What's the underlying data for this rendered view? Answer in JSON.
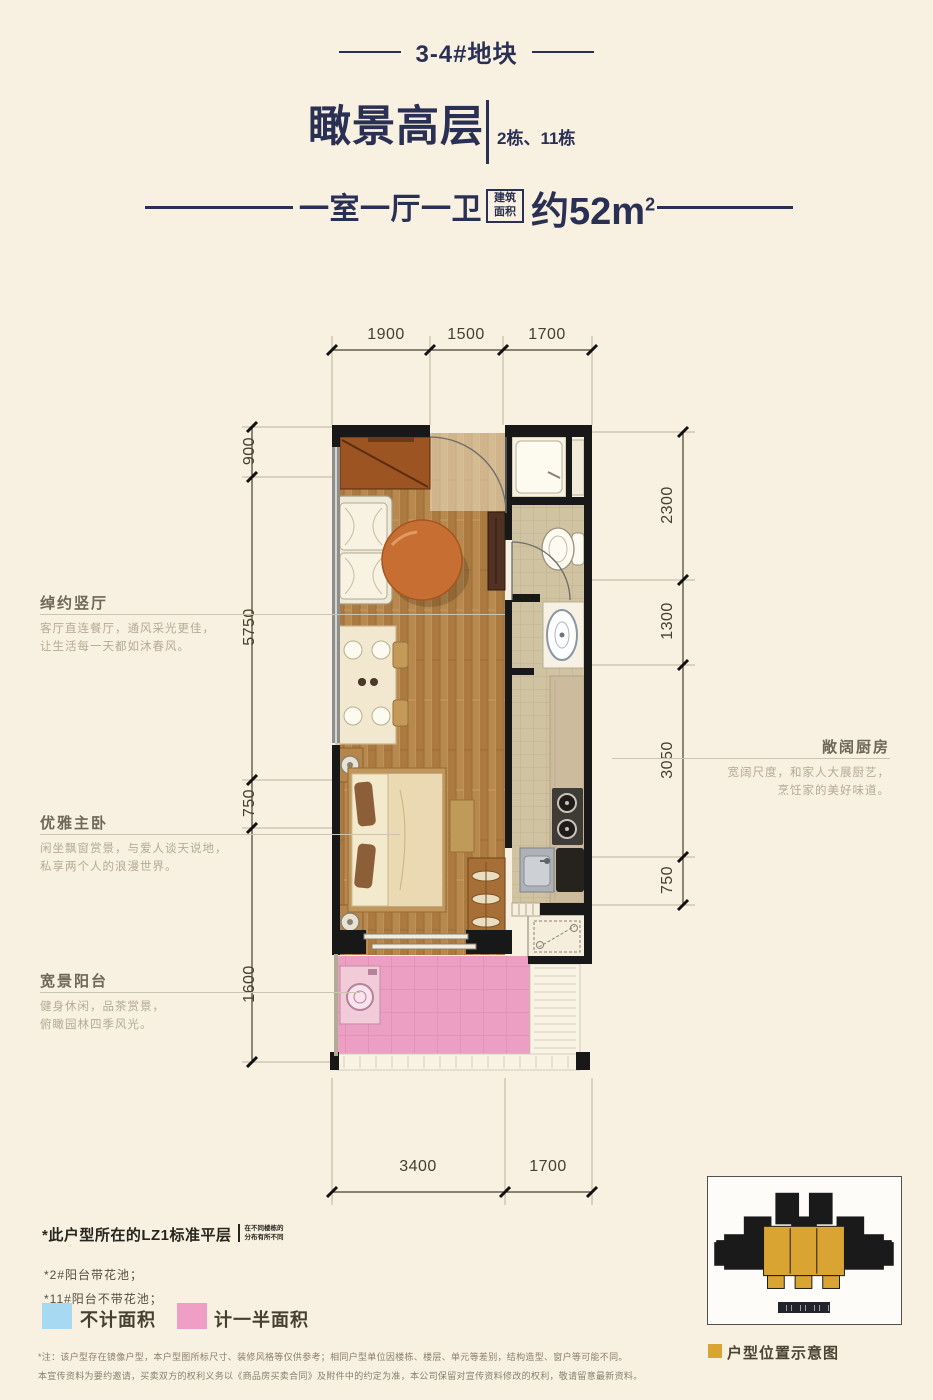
{
  "colors": {
    "background": "#f8f0e0",
    "accent_navy": "#2a3054",
    "wall_black": "#181818",
    "balcony_pink": "#ec9fc3",
    "legend_blue": "#a7d9f2",
    "legend_pink": "#ef9fc6",
    "site_gold": "#d9a432"
  },
  "header": {
    "lot": "3-4#地块",
    "title": "瞰景高层",
    "buildings": "2栋、11栋",
    "layout": "一室一厅一卫",
    "area_label_line1": "建筑",
    "area_label_line2": "面积",
    "area_value": "约52m",
    "area_sup": "2"
  },
  "plan": {
    "dims_top": [
      "1900",
      "1500",
      "1700"
    ],
    "dims_left": [
      "900",
      "5750",
      "750",
      "1600"
    ],
    "dims_right": [
      "2300",
      "1300",
      "3050",
      "750"
    ],
    "dims_bottom": [
      "3400",
      "1700"
    ]
  },
  "callouts": {
    "living": {
      "title": "绰约竖厅",
      "desc1": "客厅直连餐厅，通风采光更佳，",
      "desc2": "让生活每一天都如沐春风。"
    },
    "bedroom": {
      "title": "优雅主卧",
      "desc1": "闲坐飘窗赏景，与爱人谈天说地，",
      "desc2": "私享两个人的浪漫世界。"
    },
    "balcony": {
      "title": "宽景阳台",
      "desc1": "健身休闲，品茶赏景，",
      "desc2": "俯瞰园林四季风光。"
    },
    "kitchen": {
      "title": "敞阔厨房",
      "desc1": "宽阔尺度，和家人大展厨艺，",
      "desc2": "烹饪家的美好味道。"
    }
  },
  "notes": {
    "floor_note": "*此户型所在的LZ1标准平层",
    "floor_note_side1": "在不同楼栋的",
    "floor_note_side2": "分布有所不同",
    "note1": "*2#阳台带花池；",
    "note2": "*11#阳台不带花池；"
  },
  "legend": {
    "no_area": "不计面积",
    "half_area": "计一半面积",
    "no_area_style": "background:#a7d9f2",
    "half_area_style": "background:#ef9fc6"
  },
  "site": {
    "caption": "户型位置示意图",
    "marker_style": "background:#d9a432"
  },
  "disclaimer": {
    "line1": "*注：该户型存在镜像户型，本户型图所标尺寸、装修风格等仅供参考；相同户型单位因楼栋、楼层、单元等差别，结构造型、窗户等可能不同。",
    "line2": "本宣传资料为要约邀请，买卖双方的权利义务以《商品房买卖合同》及附件中的约定为准，本公司保留对宣传资料修改的权利，敬请留意最新资料。"
  }
}
